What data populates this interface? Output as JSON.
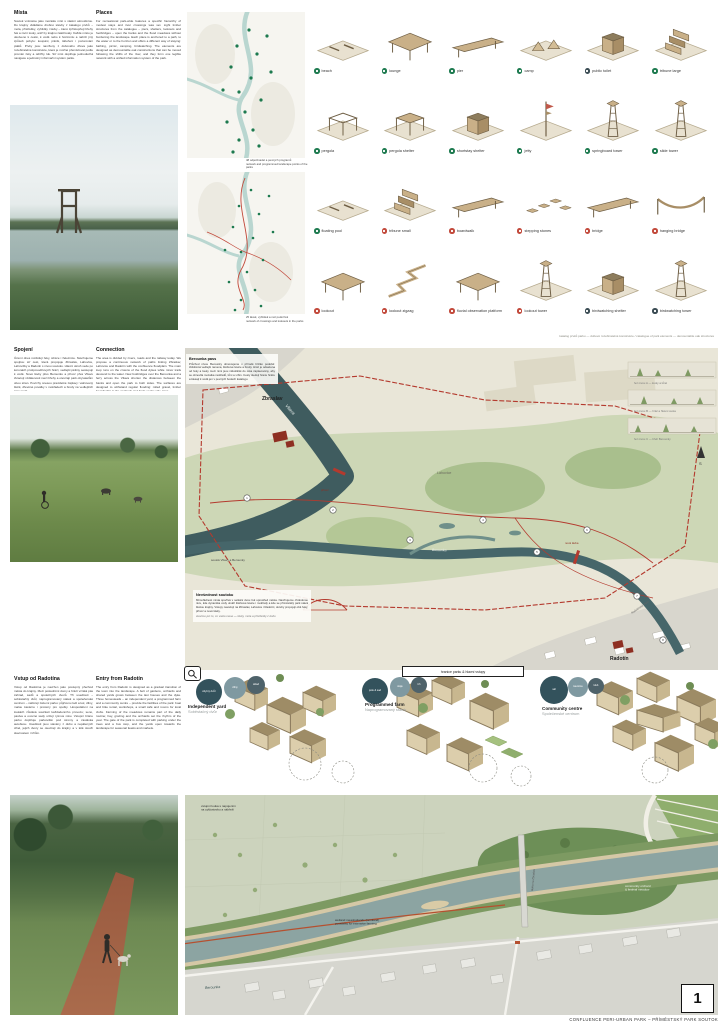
{
  "footer": {
    "text": "CONFLUENCE PERI-URBAN PARK – PŘÍMĚSTSKÝ PARK SOUTOK",
    "page": "1"
  },
  "sections": {
    "places": {
      "heading_cs": "Místa",
      "body_cs": "Soutok vnímáme jako mozaiku míst s vlastní atmosférou. Do krajiny vkládáme drobné stavby z katalogu prvků – mola, přístřešky, vyhlídky i lávky – které zpřístupňují břehy řek a nivní louky, aniž by krajinu zatěžovaly. Každé místo je ukotveno k cestě, k vodě nebo k horizontu a nabízí jiný způsob pobytu: koupání, piknik, táboření i pozorování ptáků. Prvky jsou navrženy z dubového dřeva jako rozebíratelné konstrukce, které je možné přemisťovat podle proměn řeky a údržby luk. Síť míst doplňuje jednoduchá navigace a jednotný informační systém parku.",
      "heading_en": "Places",
      "body_en": "For recreational park-wide features a specific hierarchy of modest stays and river crossings was set. Light timber structures from the catalogue – piers, shelters, lookouts and footbridges – open the banks and the flood meadows without burdening the landscape. Each place is anchored to a path, to the water or to the horizon and offers a different way of staying: bathing, picnic, camping, birdwatching. The elements are designed as demountable oak constructions that can be moved following the shifts of the river, and they form one legible network with a unified information system of the park."
    },
    "connection": {
      "heading_cs": "Spojení",
      "body_cs": "Území dnes rozdělují řeky, silnice i železnice. Navrhujeme spojitou síť cest, která propojuje Zbraslav, Lahovice, Lahovičky a Radotín s nivou soutoku. Hlavní okruh vede po korunách protipovodňových hrází, vedlejší pěšiny sestupují k vodě. Nové lávky přes Berounku a přívoz přes Vltavu zkracují vzdálenosti mezi břehy a otevírají park obyvatelům obou stran. Povrchy snesou pravidelné záplavy: válcovaný štěrk, dřevěné poválky v mokřadech a brody na vedlejších ramenech.",
      "heading_en": "Connection",
      "body_en": "The area is divided by rivers, roads and the railway today. We propose a continuous network of paths linking Zbraslav, Lahovice and Radotín with the confluence floodplain. The main loop runs on the crowns of the flood dykes while minor trails descend to the water. New footbridges over the Berounka and a ferry across the Vltava shorten the distances between the banks and open the park to both sides. The surfaces are designed to withstand regular flooding: rolled gravel, timber boardwalks in the wetlands and fords on the side arms."
    },
    "entry": {
      "heading_cs": "Vstup od Radotína",
      "body_cs": "Vstup od Radotína je navržen jako postupný přechod města do krajiny. Mezi posledními domy a hrází vzniká pás zahrad, sadů a společných dvorů. Tři usedlosti – soběstačný dvůr, naprogramovaný statek a společenské centrum – nabízejí zázemí parku: půjčovnu lodí a kol, dílny, malou kavárnu i prostory pro spolky. Hospodaření na loukách zůstává součástí každodenního provozu; seno, pastva a ovocné sady určují rytmus roku. Vstupní bránu parku doplňuje parkoviště pod stromy a zastávka autobusu. Usedlosti jsou stavěny z dubu a nepálených cihel, jejich dvory se otevírají do krajiny a v létě slouží slavnostem i trhům.",
      "heading_en": "Entry from Radotín",
      "body_en": "The entry from Radotín is designed as a gradual transition of the town into the landscape. A belt of gardens, orchards and shared yards grows between the last houses and the dyke. Three homesteads – an independent yard, a programmed farm and a community centre – provide the facilities of the park: boat and bike rental, workshops, a small café and rooms for local clubs. Farming of the meadows remains part of the daily routine; hay, grazing and the orchards set the rhythm of the year. The gate of the park is completed with parking under the trees and a bus stop, and the yards open towards the landscape for seasonal feasts and markets."
    }
  },
  "minimaps": {
    "cap1_l1": "48 odpočívadel a pevných programů",
    "cap1_l2": "network and programmed landscape points of the parks",
    "cap2_l1": "25 lávek, vyhlídek a mol podél řek",
    "cap2_l2": "network of crossings and lookouts in the parks"
  },
  "catalog": {
    "caption": "katalog prvků parku — dubové rozebíratelné konstrukce / catalogue of park elements — demountable oak structures",
    "rows": [
      {
        "items": [
          {
            "label": "beach",
            "color": "#1d7a4f",
            "variant": "flat"
          },
          {
            "label": "lounge",
            "color": "#1d7a4f",
            "variant": "deck"
          },
          {
            "label": "pier",
            "color": "#1d7a4f",
            "variant": "bridge"
          },
          {
            "label": "camp",
            "color": "#1d7a4f",
            "variant": "camp"
          },
          {
            "label": "public toilet",
            "color": "#3a4b53",
            "variant": "hut"
          },
          {
            "label": "tribune large",
            "color": "#1d7a4f",
            "variant": "tribune"
          }
        ]
      },
      {
        "items": [
          {
            "label": "pergola",
            "color": "#1d7a4f",
            "variant": "frame"
          },
          {
            "label": "pergola shelter",
            "color": "#1d7a4f",
            "variant": "frame-roof"
          },
          {
            "label": "shortstay shelter",
            "color": "#1d7a4f",
            "variant": "hut"
          },
          {
            "label": "jetty",
            "color": "#1d7a4f",
            "variant": "mast"
          },
          {
            "label": "springboard tower",
            "color": "#1d7a4f",
            "variant": "tower"
          },
          {
            "label": "slide tower",
            "color": "#1d7a4f",
            "variant": "tower"
          }
        ]
      },
      {
        "items": [
          {
            "label": "floating pool",
            "color": "#1d7a4f",
            "variant": "flat"
          },
          {
            "label": "tribune small",
            "color": "#c2493b",
            "variant": "tribune"
          },
          {
            "label": "boardwalk",
            "color": "#c2493b",
            "variant": "bridge"
          },
          {
            "label": "stepping stones",
            "color": "#c2493b",
            "variant": "dots"
          },
          {
            "label": "bridge",
            "color": "#c2493b",
            "variant": "bridge"
          },
          {
            "label": "hanging bridge",
            "color": "#c2493b",
            "variant": "bridge-curve"
          }
        ]
      },
      {
        "items": [
          {
            "label": "lookout",
            "color": "#c2493b",
            "variant": "deck"
          },
          {
            "label": "lookout zigzag",
            "color": "#c2493b",
            "variant": "zigzag"
          },
          {
            "label": "fluvial observation platform",
            "color": "#c2493b",
            "variant": "deck"
          },
          {
            "label": "lookout tower",
            "color": "#c2493b",
            "variant": "tower"
          },
          {
            "label": "birdwatching shelter",
            "color": "#3a4b53",
            "variant": "hut"
          },
          {
            "label": "birdwatching tower",
            "color": "#3a4b53",
            "variant": "tower"
          }
        ]
      }
    ]
  },
  "master_map": {
    "legend_badge": "hranice parku & hlavní vstupy",
    "berounka_pass": {
      "heading": "Berounka pass",
      "body": "Průchod nivou Berounky obnovujeme v přírodě blízké podobě: zklidněná vedlejší ramena, štěrkové lavice a brody. Hráz je odsazena od řeky a louky mezi nimi jsou několikrát do roka zaplavovány, aby se obnovila mozaika mokřadů, tůní a vrbin. Cesty sledují hranu hráze a klesají k vodě jen v pevných bodech katalogu."
    },
    "soutok_note": {
      "heading": "Nevšednost soutoku",
      "body": "Mimořádnost místa spočívá v setkání dvou řek uprostřed města. Navrhujeme chráněnou nivu, kde dynamika vody utváří štěrkové lavice i mokřady a kde se příměstský park stává školou krajiny. Vstupy navazují na Zbraslav, Lahovice i Radotín; okruhy propojují obě řeky, přívoz a nové lávky.",
      "note": "stavíme jen to, co voda unese — lávky, mola a přístřešky z dubu"
    },
    "labels": [
      {
        "text": "Vltava"
      },
      {
        "text": "Berounka"
      },
      {
        "text": "Zbraslav"
      },
      {
        "text": "Radotín"
      },
      {
        "text": "Lahovice"
      },
      {
        "text": "soutok Vltavy a Berounky"
      },
      {
        "text": "nová lávka"
      },
      {
        "text": "přívoz"
      },
      {
        "text": "Radotínský most"
      }
    ],
    "markers": [
      "1",
      "2",
      "3",
      "4",
      "5",
      "6",
      "7",
      "8"
    ],
    "profile_captions": [
      "řez nivou A — louky a tůně",
      "řez nivou B — hráz a hlavní cesta",
      "řez nivou C — břeh Berounky"
    ]
  },
  "clusters": [
    {
      "title": "Independent yard",
      "subtitle": "Soběstačný dvůr",
      "bubbles": [
        "obytný dvůr",
        "dílny",
        "sklad"
      ]
    },
    {
      "title": "Programmed farm",
      "subtitle": "Naprogramovaný statek",
      "bubbles": [
        "pole & sad",
        "stáje",
        "trh"
      ]
    },
    {
      "title": "Community centre",
      "subtitle": "Společenské centrum",
      "bubbles": [
        "sál",
        "kavárna",
        "klub"
      ]
    }
  ],
  "aerial": {
    "labels": [
      {
        "lines": [
          "vstupní louka s napojením",
          "na cyklostezku a nábřeží"
        ]
      },
      {
        "lines": [
          "wetland meadowlands (farmland)",
          "possibility for extensive farming"
        ]
      },
      {
        "lines": [
          "community orchard",
          "& festival meadow"
        ]
      },
      {
        "lines": [
          "Berounka"
        ]
      },
      {
        "lines": [
          "lávka na Zbraslav"
        ]
      }
    ]
  }
}
